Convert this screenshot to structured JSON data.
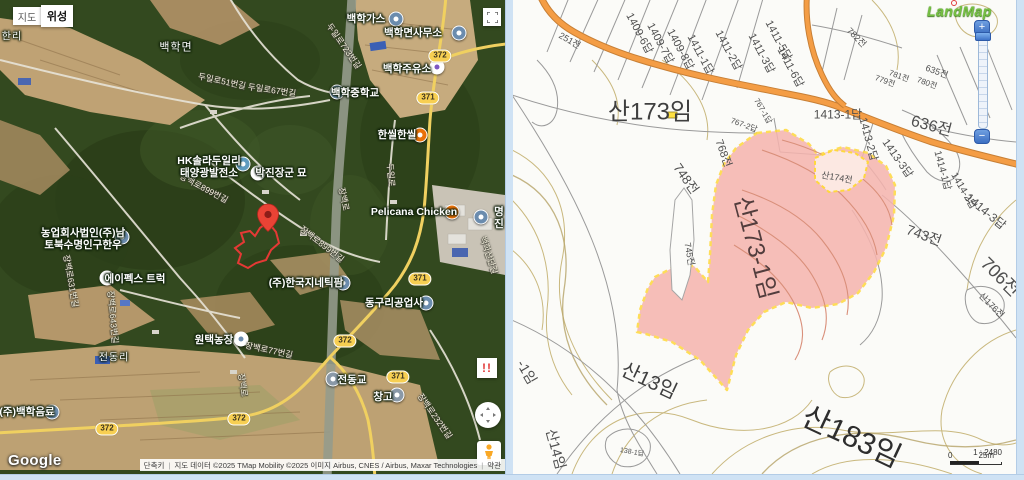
{
  "left_map": {
    "type_buttons": {
      "map": "지도",
      "satellite": "위성"
    },
    "google_logo": "Google",
    "attribution": {
      "shortcut": "단축키",
      "credits": "지도 데이터 ©2025 TMap Mobility ©2025 이미지 Airbus, CNES / Airbus, Maxar Technologies",
      "terms": "약관"
    },
    "warning_button": "!!",
    "poi_labels": [
      {
        "t": "한리",
        "x": 12,
        "y": 37,
        "c": "place-label",
        "n": "place-label-hanri",
        "i": false,
        "fs": 10
      },
      {
        "t": "백학면",
        "x": 176,
        "y": 48,
        "c": "place-label",
        "n": "place-label-baekhak-myeon",
        "i": false
      },
      {
        "t": "전동리",
        "x": 114,
        "y": 358,
        "c": "place-label",
        "n": "place-label-jeondong-ri",
        "i": false,
        "fs": 10
      },
      {
        "t": "백학가스",
        "x": 366,
        "y": 19,
        "n": "poi-baekhak-gas",
        "i": true
      },
      {
        "t": "백학면사무소",
        "x": 413,
        "y": 33,
        "n": "poi-baekhak-office",
        "i": true
      },
      {
        "t": "백학주유소",
        "x": 407,
        "y": 69,
        "n": "poi-baekhak-station",
        "i": true
      },
      {
        "t": "백학중학교",
        "x": 355,
        "y": 93,
        "n": "poi-baekhak-school",
        "i": true
      },
      {
        "t": "한씰한씰",
        "x": 397,
        "y": 135,
        "n": "poi-hanssil",
        "i": true
      },
      {
        "t": "HK솔라두일리\n태양광발전소",
        "x": 209,
        "y": 167,
        "n": "poi-hk-solar",
        "i": true
      },
      {
        "t": "박진장군 묘",
        "x": 281,
        "y": 173,
        "n": "poi-parkjin-tomb",
        "i": true
      },
      {
        "t": "Pelicana Chicken",
        "x": 414,
        "y": 212,
        "n": "poi-pelicana",
        "i": true
      },
      {
        "t": "명진",
        "x": 499,
        "y": 218,
        "n": "poi-myeongjin",
        "i": true
      },
      {
        "t": "농업회사법인(주)남\n토북수명인구한우",
        "x": 83,
        "y": 239,
        "n": "poi-farm-corp",
        "i": true
      },
      {
        "t": "에이펙스 트럭",
        "x": 135,
        "y": 279,
        "n": "poi-apex-truck",
        "i": true
      },
      {
        "t": "(주)한국지네틱팜",
        "x": 306,
        "y": 283,
        "n": "poi-genetic-farm",
        "i": true
      },
      {
        "t": "동구리공업사",
        "x": 394,
        "y": 303,
        "n": "poi-dongguri-industry",
        "i": true
      },
      {
        "t": "원택농장",
        "x": 214,
        "y": 340,
        "n": "poi-wontaek-farm",
        "i": true
      },
      {
        "t": "(주)백학음료",
        "x": 27,
        "y": 412,
        "n": "poi-baekhak-beverage",
        "i": true
      },
      {
        "t": "전동교",
        "x": 352,
        "y": 380,
        "n": "poi-jeondong-bridge",
        "i": true
      },
      {
        "t": "창고",
        "x": 383,
        "y": 397,
        "n": "poi-warehouse",
        "i": true
      }
    ],
    "poi_icons": [
      {
        "x": 396,
        "y": 19,
        "bg": "#6b8cae",
        "dot": "#ffffff",
        "n": "gas-company-icon",
        "i": true
      },
      {
        "x": 459,
        "y": 33,
        "bg": "#6b8cae",
        "dot": "#ffffff",
        "n": "township-office-icon",
        "i": true
      },
      {
        "x": 437,
        "y": 67,
        "bg": "#ffffff",
        "dot": "#7e57c2",
        "n": "gas-station-icon",
        "i": true
      },
      {
        "x": 337,
        "y": 92,
        "bg": "#6b8cae",
        "dot": "#ffffff",
        "n": "school-icon",
        "i": true
      },
      {
        "x": 420,
        "y": 135,
        "bg": "#e8710a",
        "dot": "#ffffff",
        "n": "restaurant-icon",
        "i": true
      },
      {
        "x": 243,
        "y": 164,
        "bg": "#5f9bbf",
        "dot": "#ffffff",
        "n": "solar-plant-icon",
        "i": true
      },
      {
        "x": 258,
        "y": 173,
        "bg": "#ffffff",
        "dot": "#8e5bb5",
        "n": "tomb-icon",
        "i": true
      },
      {
        "x": 452,
        "y": 212,
        "bg": "#e8710a",
        "dot": "#ffffff",
        "n": "restaurant-icon",
        "i": true
      },
      {
        "x": 481,
        "y": 217,
        "bg": "#6b8cae",
        "dot": "#ffffff",
        "n": "company-icon",
        "i": true
      },
      {
        "x": 122,
        "y": 237,
        "bg": "#6b8cae",
        "dot": "#ffffff",
        "n": "company-icon",
        "i": true
      },
      {
        "x": 107,
        "y": 278,
        "bg": "#ffffff",
        "dot": "#34a853",
        "n": "truck-shop-icon",
        "i": true
      },
      {
        "x": 343,
        "y": 283,
        "bg": "#6b8cae",
        "dot": "#ffffff",
        "n": "company-icon",
        "i": true
      },
      {
        "x": 426,
        "y": 303,
        "bg": "#6b8cae",
        "dot": "#ffffff",
        "n": "industry-icon",
        "i": true
      },
      {
        "x": 241,
        "y": 339,
        "bg": "#ffffff",
        "dot": "#6b8cae",
        "n": "farm-icon",
        "i": true
      },
      {
        "x": 52,
        "y": 412,
        "bg": "#6b8cae",
        "dot": "#ffffff",
        "n": "company-icon",
        "i": true
      },
      {
        "x": 333,
        "y": 379,
        "bg": "#8a99a8",
        "dot": "#ffffff",
        "n": "bridge-icon",
        "i": true
      },
      {
        "x": 397,
        "y": 395,
        "bg": "#8a99a8",
        "dot": "#ffffff",
        "n": "warehouse-icon",
        "i": true
      }
    ],
    "road_labels": [
      {
        "t": "두일로51번길",
        "x": 222,
        "y": 81,
        "r": 12,
        "n": "road-name",
        "i": false
      },
      {
        "t": "두일로67번길",
        "x": 272,
        "y": 90,
        "r": 8,
        "n": "road-name",
        "i": false
      },
      {
        "t": "두일로723번길",
        "x": 344,
        "y": 46,
        "r": 55,
        "n": "road-name",
        "i": false
      },
      {
        "t": "두일로",
        "x": 391,
        "y": 175,
        "r": 85,
        "n": "road-name",
        "i": false
      },
      {
        "t": "장백로899번길",
        "x": 204,
        "y": 188,
        "r": 28,
        "n": "road-name",
        "i": false
      },
      {
        "t": "장백로899번길",
        "x": 322,
        "y": 244,
        "r": 38,
        "n": "road-name",
        "i": false
      },
      {
        "t": "장백로631번길",
        "x": 71,
        "y": 281,
        "r": 80,
        "n": "road-name",
        "i": false
      },
      {
        "t": "장백로643번길",
        "x": 113,
        "y": 317,
        "r": 85,
        "n": "road-name",
        "i": false
      },
      {
        "t": "장백로77번길",
        "x": 269,
        "y": 350,
        "r": 12,
        "n": "road-name",
        "i": false
      },
      {
        "t": "장백로232번길",
        "x": 435,
        "y": 416,
        "r": 55,
        "n": "road-name",
        "i": false
      },
      {
        "t": "장백로",
        "x": 344,
        "y": 199,
        "r": 78,
        "n": "road-name",
        "i": false
      },
      {
        "t": "장백로",
        "x": 243,
        "y": 385,
        "r": 82,
        "n": "road-name",
        "i": false
      },
      {
        "t": "백학산단길",
        "x": 489,
        "y": 255,
        "r": 72,
        "n": "road-name",
        "i": false
      }
    ],
    "road_badges": [
      {
        "t": "372",
        "x": 440,
        "y": 56,
        "n": "route-badge-372",
        "i": false
      },
      {
        "t": "371",
        "x": 428,
        "y": 98,
        "n": "route-badge-371",
        "i": false
      },
      {
        "t": "371",
        "x": 420,
        "y": 279,
        "n": "route-badge-371",
        "i": false
      },
      {
        "t": "372",
        "x": 345,
        "y": 341,
        "n": "route-badge-372",
        "i": false
      },
      {
        "t": "371",
        "x": 398,
        "y": 377,
        "n": "route-badge-371",
        "i": false
      },
      {
        "t": "372",
        "x": 239,
        "y": 419,
        "n": "route-badge-372",
        "i": false
      },
      {
        "t": "372",
        "x": 107,
        "y": 429,
        "n": "route-badge-372",
        "i": false
      }
    ]
  },
  "right_map": {
    "logo": "LandMap",
    "zoom_in": "+",
    "zoom_out": "−",
    "scale_text": "1 : 2480",
    "scale_zero": "0",
    "scale_distance": "25m",
    "parcel_labels": [
      {
        "t": "1409-6답",
        "x": 128,
        "y": 33,
        "r": 62,
        "n": "parcel-label",
        "i": false
      },
      {
        "t": "1409-7답",
        "x": 149,
        "y": 43,
        "r": 62,
        "n": "parcel-label",
        "i": false
      },
      {
        "t": "1409-8답",
        "x": 169,
        "y": 49,
        "r": 62,
        "n": "parcel-label",
        "i": false
      },
      {
        "t": "1411-1답",
        "x": 189,
        "y": 54,
        "r": 62,
        "n": "parcel-label",
        "i": false
      },
      {
        "t": "1411-2답",
        "x": 217,
        "y": 50,
        "r": 62,
        "n": "parcel-label",
        "i": false
      },
      {
        "t": "1411-3답",
        "x": 250,
        "y": 53,
        "r": 62,
        "n": "parcel-label",
        "i": false
      },
      {
        "t": "1411-5답",
        "x": 267,
        "y": 40,
        "r": 62,
        "n": "parcel-label",
        "i": false
      },
      {
        "t": "1411-6답",
        "x": 279,
        "y": 67,
        "r": 62,
        "n": "parcel-label",
        "i": false
      },
      {
        "t": "251전",
        "x": 58,
        "y": 40,
        "r": 30,
        "fs": 9,
        "n": "parcel-label",
        "i": false
      },
      {
        "t": "782전",
        "x": 345,
        "y": 37,
        "r": 45,
        "fs": 9,
        "n": "parcel-label",
        "i": false
      },
      {
        "t": "767-1답",
        "x": 251,
        "y": 111,
        "r": 60,
        "fs": 8,
        "n": "parcel-label",
        "i": false
      },
      {
        "t": "767-2답",
        "x": 232,
        "y": 125,
        "r": 20,
        "fs": 8,
        "n": "parcel-label",
        "i": false
      },
      {
        "t": "768전",
        "x": 212,
        "y": 153,
        "r": 70,
        "n": "parcel-label",
        "i": false
      },
      {
        "t": "748전",
        "x": 175,
        "y": 178,
        "r": 55,
        "fs": 13,
        "n": "parcel-label",
        "i": false
      },
      {
        "t": "745전",
        "x": 178,
        "y": 254,
        "r": 80,
        "fs": 9,
        "n": "parcel-label",
        "i": false
      },
      {
        "t": "635전",
        "x": 425,
        "y": 71,
        "r": 20,
        "fs": 9,
        "n": "parcel-label",
        "i": false
      },
      {
        "t": "781전",
        "x": 387,
        "y": 76,
        "r": 20,
        "fs": 8,
        "n": "parcel-label",
        "i": false
      },
      {
        "t": "779전",
        "x": 373,
        "y": 81,
        "r": 20,
        "fs": 8,
        "n": "parcel-label",
        "i": false
      },
      {
        "t": "780전",
        "x": 415,
        "y": 83,
        "r": 20,
        "fs": 8,
        "n": "parcel-label",
        "i": false
      },
      {
        "t": "1413-1답",
        "x": 326,
        "y": 114,
        "r": 0,
        "fs": 12,
        "n": "parcel-label",
        "i": false
      },
      {
        "t": "636전",
        "x": 420,
        "y": 124,
        "r": 15,
        "fs": 16,
        "n": "parcel-label",
        "i": false
      },
      {
        "t": "1413-2답",
        "x": 357,
        "y": 139,
        "r": 75,
        "n": "parcel-label",
        "i": false
      },
      {
        "t": "1413-3답",
        "x": 386,
        "y": 158,
        "r": 55,
        "n": "parcel-label",
        "i": false
      },
      {
        "t": "1414-1답",
        "x": 432,
        "y": 170,
        "r": 75,
        "fs": 10,
        "n": "parcel-label",
        "i": false
      },
      {
        "t": "1414-2답",
        "x": 453,
        "y": 190,
        "r": 60,
        "fs": 10,
        "n": "parcel-label",
        "i": false
      },
      {
        "t": "1414-3답",
        "x": 474,
        "y": 211,
        "r": 40,
        "fs": 12,
        "n": "parcel-label",
        "i": false
      },
      {
        "t": "743전",
        "x": 412,
        "y": 235,
        "r": 20,
        "fs": 14,
        "n": "parcel-label",
        "i": false
      },
      {
        "t": "706전",
        "x": 489,
        "y": 276,
        "r": 45,
        "fs": 18,
        "n": "parcel-label",
        "i": false
      },
      {
        "t": "산176전",
        "x": 480,
        "y": 305,
        "r": 45,
        "fs": 9,
        "n": "parcel-label",
        "i": false
      },
      {
        "t": "산173임",
        "x": 138,
        "y": 109,
        "r": 0,
        "fs": 24,
        "col": "#3f3f3f",
        "n": "parcel-label-san173",
        "i": false
      },
      {
        "t": "산174전",
        "x": 325,
        "y": 177,
        "r": 10,
        "fs": 9,
        "n": "parcel-label-san174",
        "i": false
      },
      {
        "t": "산173-1임",
        "x": 246,
        "y": 247,
        "r": 75,
        "fs": 24,
        "col": "#523d3d",
        "n": "parcel-label-san173-1-highlight",
        "i": false
      },
      {
        "t": "산13임",
        "x": 138,
        "y": 379,
        "r": 25,
        "fs": 20,
        "col": "#3f3f3f",
        "n": "parcel-label-san13",
        "i": false
      },
      {
        "t": "산14임",
        "x": 44,
        "y": 449,
        "r": 75,
        "fs": 14,
        "n": "parcel-label-san14",
        "i": false
      },
      {
        "t": "-1임",
        "x": 15,
        "y": 372,
        "r": 60,
        "fs": 14,
        "n": "parcel-label-partial",
        "i": false
      },
      {
        "t": "138-1답",
        "x": 120,
        "y": 452,
        "r": 10,
        "fs": 7,
        "n": "parcel-label",
        "i": false
      },
      {
        "t": "산183임",
        "x": 341,
        "y": 434,
        "r": 25,
        "fs": 30,
        "col": "#2e2e2e",
        "n": "parcel-label-san183",
        "i": false
      }
    ]
  }
}
